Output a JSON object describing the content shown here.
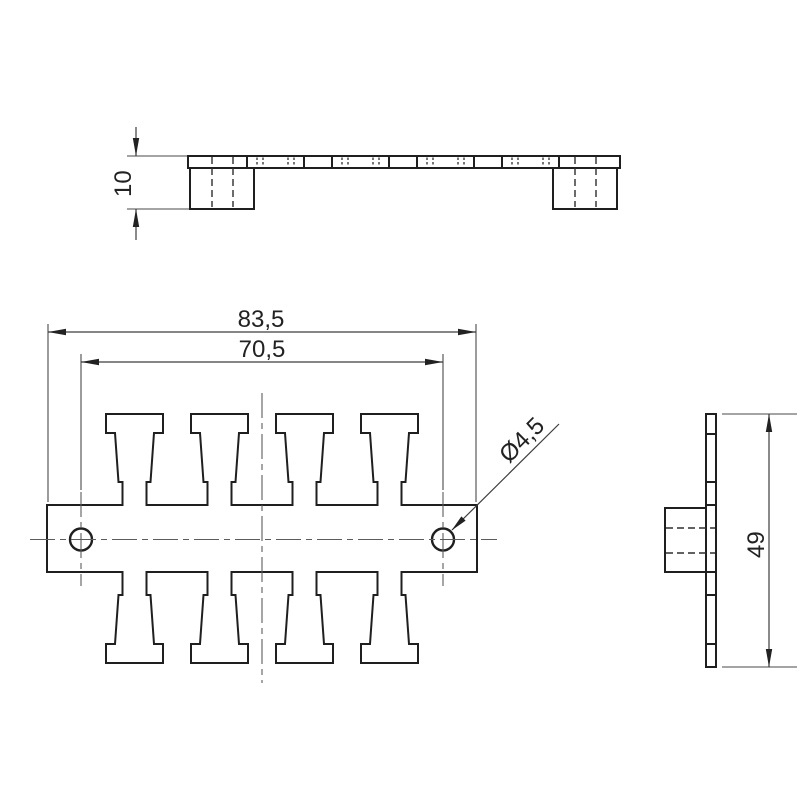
{
  "drawing": {
    "labels": {
      "overall_width": "83,5",
      "hole_spacing": "70,5",
      "hole_diameter": "Ø4,5",
      "thickness": "10",
      "overall_height": "49"
    },
    "colors": {
      "background": "#ffffff",
      "outline": "#1f1f1f",
      "thin_lines": "#3d3d3d"
    }
  }
}
